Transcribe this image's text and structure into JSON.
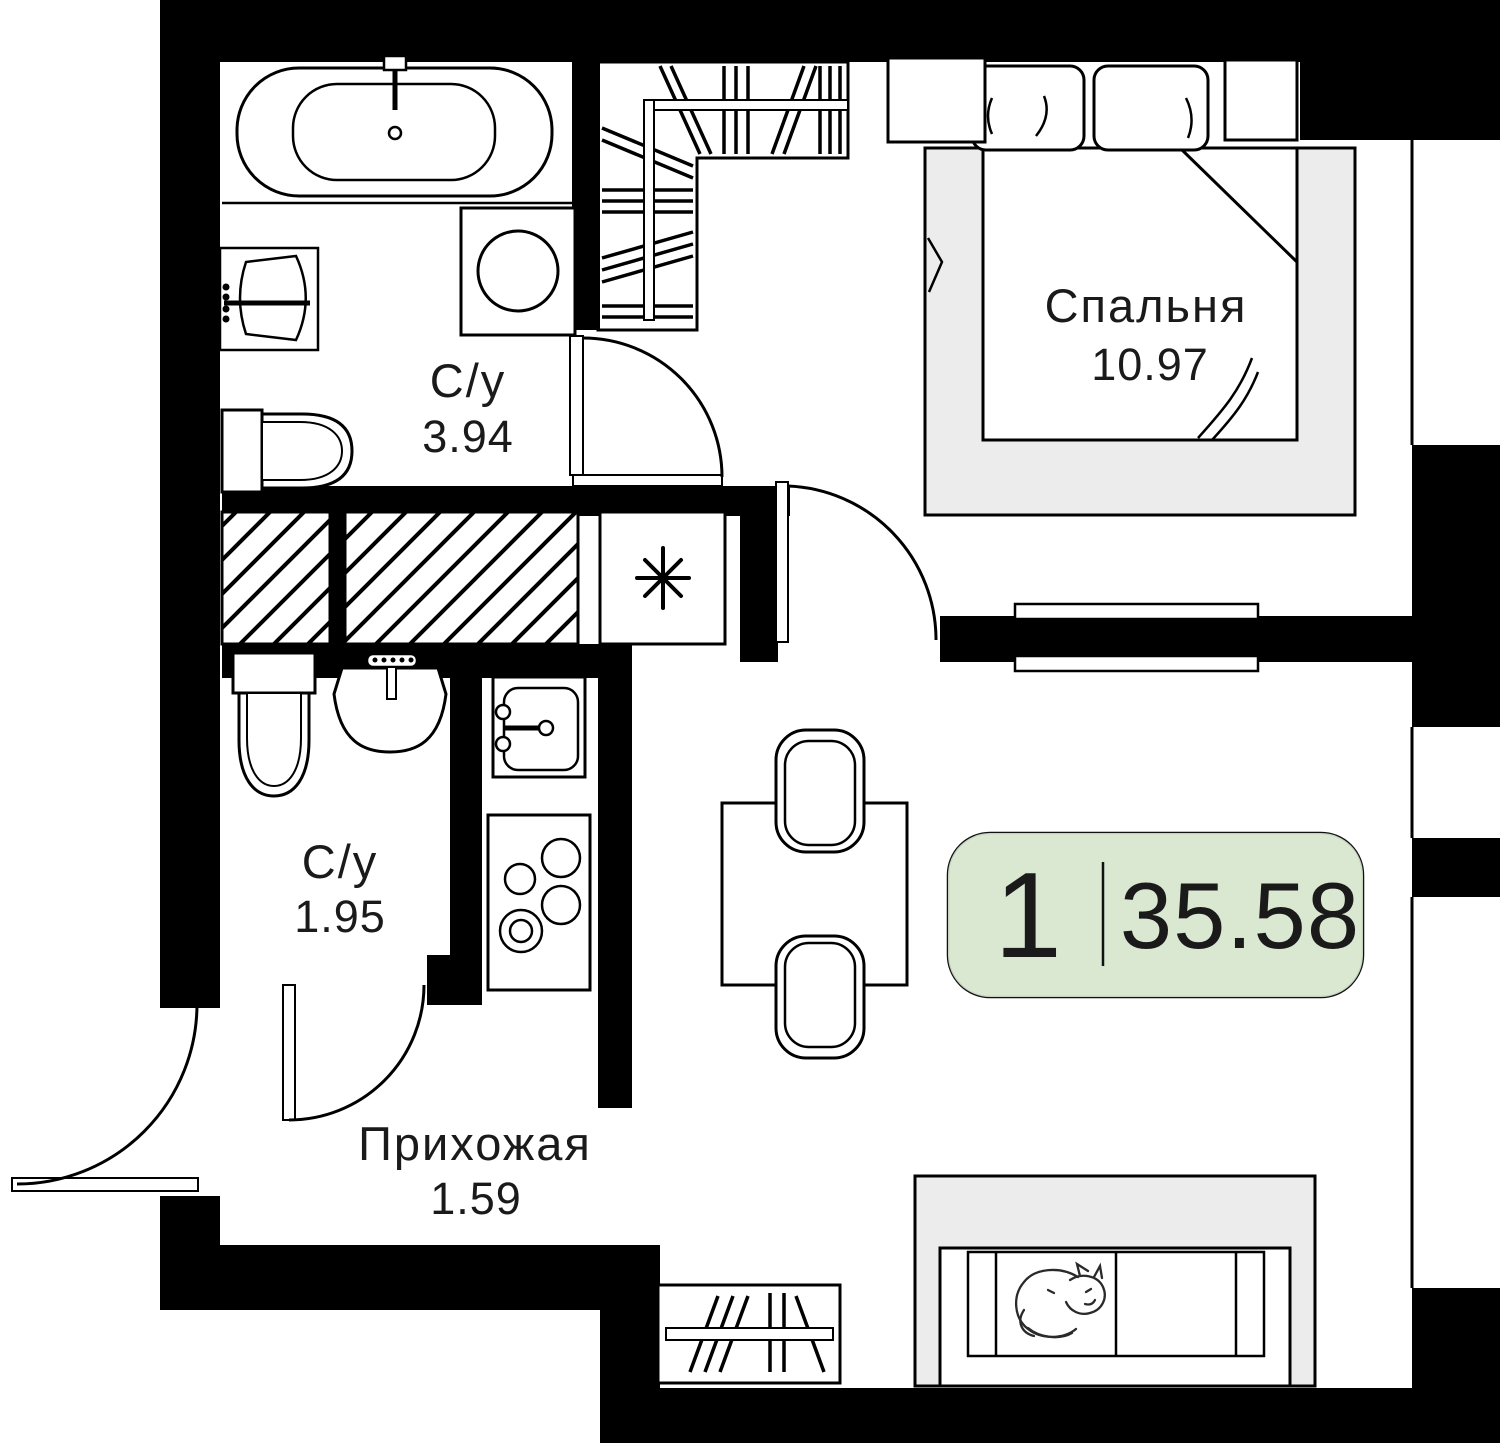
{
  "floorplan": {
    "badge": {
      "rooms_count": "1",
      "total_area": "35.58"
    },
    "rooms": [
      {
        "name": "Спальня",
        "area": "10.97"
      },
      {
        "name": "С/у",
        "area": "3.94"
      },
      {
        "name": "С/у",
        "area": "1.95"
      },
      {
        "name": "Прихожая",
        "area": "1.59"
      }
    ],
    "colors": {
      "wall": "#000000",
      "floor": "#ffffff",
      "soft_furniture": "#ececec",
      "badge_fill": "#d9e8d2",
      "badge_border": "#111111",
      "line": "#000000"
    }
  }
}
